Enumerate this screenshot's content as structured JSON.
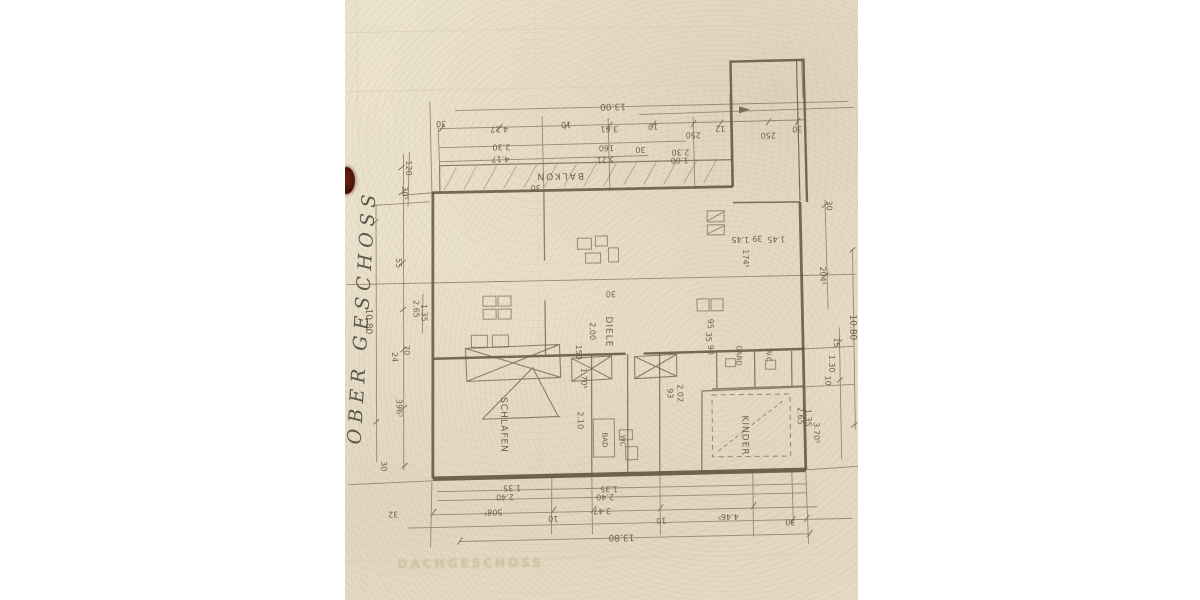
{
  "margin_notes": {
    "handwritten_label": "OBER GESCHOSS",
    "faded_label": "DACHGESCHOSS"
  },
  "colors": {
    "paper": "#ebe2cc",
    "wall_ink": "#63543f",
    "dimension_ink": "#6b5c48",
    "handwriting_ink": "#44403a",
    "faded_print": "#cdc1a5",
    "blob": "#55180f",
    "background": "#ffffff"
  },
  "plan": {
    "room_labels": [
      {
        "t": "BALKON",
        "x": 216,
        "y": 175,
        "rot": 180,
        "fs": 9,
        "ls": 2
      },
      {
        "t": "SCHLAFEN",
        "x": 157,
        "y": 424,
        "rot": 90,
        "fs": 9,
        "ls": 1
      },
      {
        "t": "DIELE",
        "x": 263,
        "y": 332,
        "rot": 90,
        "fs": 9,
        "ls": 1
      },
      {
        "t": "BAD",
        "x": 258,
        "y": 440,
        "rot": 90,
        "fs": 7
      },
      {
        "t": "WC",
        "x": 276,
        "y": 441,
        "rot": 90,
        "fs": 7
      },
      {
        "t": "GARD",
        "x": 393,
        "y": 357,
        "rot": 90,
        "fs": 7
      },
      {
        "t": "W.C",
        "x": 423,
        "y": 357,
        "rot": 90,
        "fs": 7
      },
      {
        "t": "KINDER",
        "x": 398,
        "y": 437,
        "rot": 90,
        "fs": 9,
        "ls": 1
      }
    ],
    "dimension_labels": [
      {
        "t": "13.00",
        "x": 270,
        "y": 106,
        "rot": 180,
        "fs": 9
      },
      {
        "t": "30",
        "x": 98,
        "y": 122,
        "rot": 180
      },
      {
        "t": "4.27",
        "x": 156,
        "y": 128,
        "rot": 180
      },
      {
        "t": "10",
        "x": 223,
        "y": 124,
        "rot": 180
      },
      {
        "t": "3.61",
        "x": 266,
        "y": 129,
        "rot": 180
      },
      {
        "t": "10",
        "x": 310,
        "y": 127,
        "rot": 180
      },
      {
        "t": "250",
        "x": 350,
        "y": 136,
        "rot": 180
      },
      {
        "t": "12",
        "x": 377,
        "y": 130,
        "rot": 180
      },
      {
        "t": "250",
        "x": 425,
        "y": 137,
        "rot": 180
      },
      {
        "t": "30",
        "x": 454,
        "y": 131,
        "rot": 180
      },
      {
        "t": "2.30",
        "x": 158,
        "y": 146,
        "rot": 180
      },
      {
        "t": "160",
        "x": 263,
        "y": 148,
        "rot": 180
      },
      {
        "t": "30",
        "x": 297,
        "y": 150,
        "rot": 180
      },
      {
        "t": "2.30",
        "x": 337,
        "y": 153,
        "rot": 180
      },
      {
        "t": "1.00",
        "x": 336,
        "y": 161,
        "rot": 180
      },
      {
        "t": "4.17",
        "x": 157,
        "y": 158,
        "rot": 180
      },
      {
        "t": "3.21",
        "x": 262,
        "y": 160,
        "rot": 180
      },
      {
        "t": "30",
        "x": 192,
        "y": 187,
        "rot": 180
      },
      {
        "t": "30",
        "x": 266,
        "y": 294,
        "rot": 180
      },
      {
        "t": "1.45",
        "x": 396,
        "y": 241,
        "rot": 180
      },
      {
        "t": "39",
        "x": 413,
        "y": 240,
        "rot": 180
      },
      {
        "t": "1.45",
        "x": 432,
        "y": 241,
        "rot": 180
      },
      {
        "t": "120",
        "x": 65,
        "y": 166,
        "rot": 90
      },
      {
        "t": "30⁵",
        "x": 61,
        "y": 191,
        "rot": 90
      },
      {
        "t": "55",
        "x": 54,
        "y": 261,
        "rot": 90
      },
      {
        "t": "10.80",
        "x": 23,
        "y": 319,
        "rot": 90,
        "fs": 9
      },
      {
        "t": "2.65",
        "x": 71,
        "y": 307,
        "rot": 90
      },
      {
        "t": "1.35",
        "x": 79,
        "y": 311,
        "rot": 90
      },
      {
        "t": "70",
        "x": 61,
        "y": 348,
        "rot": 90
      },
      {
        "t": "24",
        "x": 49,
        "y": 355,
        "rot": 90
      },
      {
        "t": "396⁵",
        "x": 53,
        "y": 406,
        "rot": 90
      },
      {
        "t": "30",
        "x": 37,
        "y": 464,
        "rot": 90
      },
      {
        "t": "30",
        "x": 485,
        "y": 208,
        "rot": 90
      },
      {
        "t": "204⁵",
        "x": 478,
        "y": 278,
        "rot": 90
      },
      {
        "t": "10.80",
        "x": 507,
        "y": 330,
        "rot": 90,
        "fs": 9
      },
      {
        "t": "15",
        "x": 491,
        "y": 345,
        "rot": 90
      },
      {
        "t": "1.30",
        "x": 486,
        "y": 366,
        "rot": 90
      },
      {
        "t": "10",
        "x": 482,
        "y": 383,
        "rot": 90
      },
      {
        "t": "2.65",
        "x": 454,
        "y": 418,
        "rot": 90
      },
      {
        "t": "1.35",
        "x": 462,
        "y": 420,
        "rot": 90
      },
      {
        "t": "3.70⁵",
        "x": 470,
        "y": 435,
        "rot": 90
      },
      {
        "t": "2.00",
        "x": 247,
        "y": 331,
        "rot": 90
      },
      {
        "t": "150",
        "x": 233,
        "y": 352,
        "rot": 90
      },
      {
        "t": "1.70⁵",
        "x": 238,
        "y": 378,
        "rot": 90
      },
      {
        "t": "2.10",
        "x": 234,
        "y": 420,
        "rot": 90
      },
      {
        "t": "93",
        "x": 324,
        "y": 394,
        "rot": 90
      },
      {
        "t": "2.02",
        "x": 334,
        "y": 394,
        "rot": 90
      },
      {
        "t": "95",
        "x": 365,
        "y": 325,
        "rot": 90
      },
      {
        "t": "35",
        "x": 363,
        "y": 338,
        "rot": 90
      },
      {
        "t": "90",
        "x": 365,
        "y": 351,
        "rot": 90
      },
      {
        "t": "174⁵",
        "x": 401,
        "y": 260,
        "rot": 90
      },
      {
        "t": "1.35",
        "x": 165,
        "y": 487,
        "rot": 180
      },
      {
        "t": "2.40",
        "x": 158,
        "y": 496,
        "rot": 180
      },
      {
        "t": "508⁵",
        "x": 146,
        "y": 511,
        "rot": 180
      },
      {
        "t": "10",
        "x": 206,
        "y": 518,
        "rot": 180
      },
      {
        "t": "32",
        "x": 46,
        "y": 512,
        "rot": 180
      },
      {
        "t": "1.35",
        "x": 262,
        "y": 489,
        "rot": 180
      },
      {
        "t": "2.40",
        "x": 258,
        "y": 497,
        "rot": 180
      },
      {
        "t": "3.47",
        "x": 255,
        "y": 511,
        "rot": 180
      },
      {
        "t": "10",
        "x": 314,
        "y": 521,
        "rot": 180
      },
      {
        "t": "4.46⁵",
        "x": 381,
        "y": 518,
        "rot": 180
      },
      {
        "t": "30",
        "x": 443,
        "y": 524,
        "rot": 180
      },
      {
        "t": "13.80",
        "x": 274,
        "y": 537,
        "rot": 180,
        "fs": 9
      }
    ]
  }
}
